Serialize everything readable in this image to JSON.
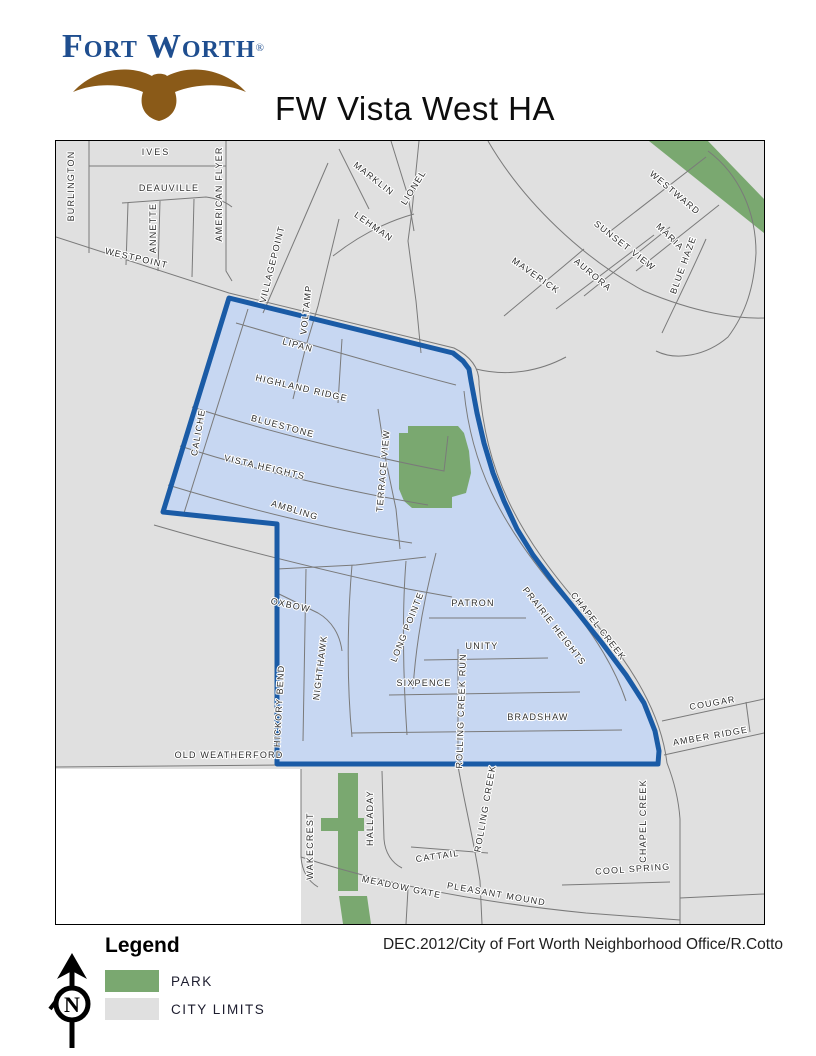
{
  "header": {
    "logo": {
      "text": "Fort Worth",
      "registered": "®"
    },
    "title": "FW Vista West HA"
  },
  "map": {
    "colors": {
      "city_limits": "#E0E0E0",
      "outside_city": "#FFFFFF",
      "road": "#7A7A7A",
      "ha_fill": "#C7D7F2",
      "ha_border": "#1A5BA6",
      "park": "#7AA870"
    },
    "street_labels": [
      {
        "t": "BURLINGTON",
        "x": 18,
        "y": 45,
        "r": -90
      },
      {
        "t": "IVES",
        "x": 100,
        "y": 14,
        "r": 0,
        "ls": 2
      },
      {
        "t": "DEAUVILLE",
        "x": 113,
        "y": 50,
        "r": 0
      },
      {
        "t": "ANNETTE",
        "x": 100,
        "y": 87,
        "r": -90
      },
      {
        "t": "AMERICAN FLYER",
        "x": 166,
        "y": 53,
        "r": -90
      },
      {
        "t": "WESTPOINT",
        "x": 80,
        "y": 120,
        "r": 13
      },
      {
        "t": "VILLAGEPOINT",
        "x": 219,
        "y": 124,
        "r": -76
      },
      {
        "t": "VOLTAMP",
        "x": 253,
        "y": 169,
        "r": -84
      },
      {
        "t": "MARKLIN",
        "x": 316,
        "y": 40,
        "r": 38
      },
      {
        "t": "LIONEL",
        "x": 360,
        "y": 48,
        "r": -58
      },
      {
        "t": "LEHMAN",
        "x": 316,
        "y": 88,
        "r": 35
      },
      {
        "t": "MAVERICK",
        "x": 478,
        "y": 137,
        "r": 35
      },
      {
        "t": "WESTWARD",
        "x": 617,
        "y": 54,
        "r": 40
      },
      {
        "t": "MARIA",
        "x": 612,
        "y": 98,
        "r": 44
      },
      {
        "t": "SUNSET VIEW",
        "x": 567,
        "y": 107,
        "r": 38
      },
      {
        "t": "AURORA",
        "x": 535,
        "y": 136,
        "r": 40
      },
      {
        "t": "BLUE HAZE",
        "x": 630,
        "y": 125,
        "r": -70
      },
      {
        "t": "LIPAN",
        "x": 241,
        "y": 207,
        "r": 15
      },
      {
        "t": "HIGHLAND RIDGE",
        "x": 245,
        "y": 250,
        "r": 13
      },
      {
        "t": "BLUESTONE",
        "x": 226,
        "y": 288,
        "r": 15
      },
      {
        "t": "VISTA HEIGHTS",
        "x": 208,
        "y": 329,
        "r": 13
      },
      {
        "t": "AMBLING",
        "x": 238,
        "y": 372,
        "r": 17
      },
      {
        "t": "CALICHE",
        "x": 145,
        "y": 292,
        "r": -80
      },
      {
        "t": "TERRACE VIEW",
        "x": 330,
        "y": 330,
        "r": -85
      },
      {
        "t": "OXBOW",
        "x": 234,
        "y": 467,
        "r": 12
      },
      {
        "t": "NIGHTHAWK",
        "x": 267,
        "y": 527,
        "r": -83
      },
      {
        "t": "HICKORY BEND",
        "x": 226,
        "y": 565,
        "r": -87
      },
      {
        "t": "LONG POINTE",
        "x": 354,
        "y": 487,
        "r": -68
      },
      {
        "t": "PATRON",
        "x": 417,
        "y": 465,
        "r": 0
      },
      {
        "t": "UNITY",
        "x": 426,
        "y": 508,
        "r": 0
      },
      {
        "t": "SIXPENCE",
        "x": 368,
        "y": 545,
        "r": 0
      },
      {
        "t": "ROLLING CREEK RUN",
        "x": 408,
        "y": 570,
        "r": -88
      },
      {
        "t": "BRADSHAW",
        "x": 482,
        "y": 579,
        "r": 0
      },
      {
        "t": "PRAIRIE HEIGHTS",
        "x": 496,
        "y": 487,
        "r": 52
      },
      {
        "t": "CHAPEL CREEK",
        "x": 540,
        "y": 487,
        "r": 52
      },
      {
        "t": "COUGAR",
        "x": 657,
        "y": 565,
        "r": -10
      },
      {
        "t": "AMBER RIDGE",
        "x": 655,
        "y": 598,
        "r": -10
      },
      {
        "t": "OLD WEATHERFORD",
        "x": 173,
        "y": 617,
        "r": 0
      },
      {
        "t": "WAKECREST",
        "x": 257,
        "y": 705,
        "r": -90
      },
      {
        "t": "HALLADAY",
        "x": 317,
        "y": 677,
        "r": -90
      },
      {
        "t": "CATTAIL",
        "x": 382,
        "y": 718,
        "r": -8
      },
      {
        "t": "MEADOW GATE",
        "x": 345,
        "y": 749,
        "r": 12
      },
      {
        "t": "PLEASANT MOUND",
        "x": 440,
        "y": 756,
        "r": 10
      },
      {
        "t": "ROLLING CREEK",
        "x": 432,
        "y": 668,
        "r": -80
      },
      {
        "t": "COOL SPRING",
        "x": 577,
        "y": 731,
        "r": -4
      },
      {
        "t": "CHAPEL CREEK",
        "x": 590,
        "y": 680,
        "r": -90
      }
    ]
  },
  "legend": {
    "heading": "Legend",
    "items": [
      {
        "label": "PARK",
        "color": "#7AA870"
      },
      {
        "label": "CITY LIMITS",
        "color": "#E0E0E0"
      }
    ]
  },
  "credit": {
    "text": "DEC.2012/City of Fort Worth Neighborhood Office/R.Cotto"
  },
  "compass": {
    "letter": "N"
  }
}
